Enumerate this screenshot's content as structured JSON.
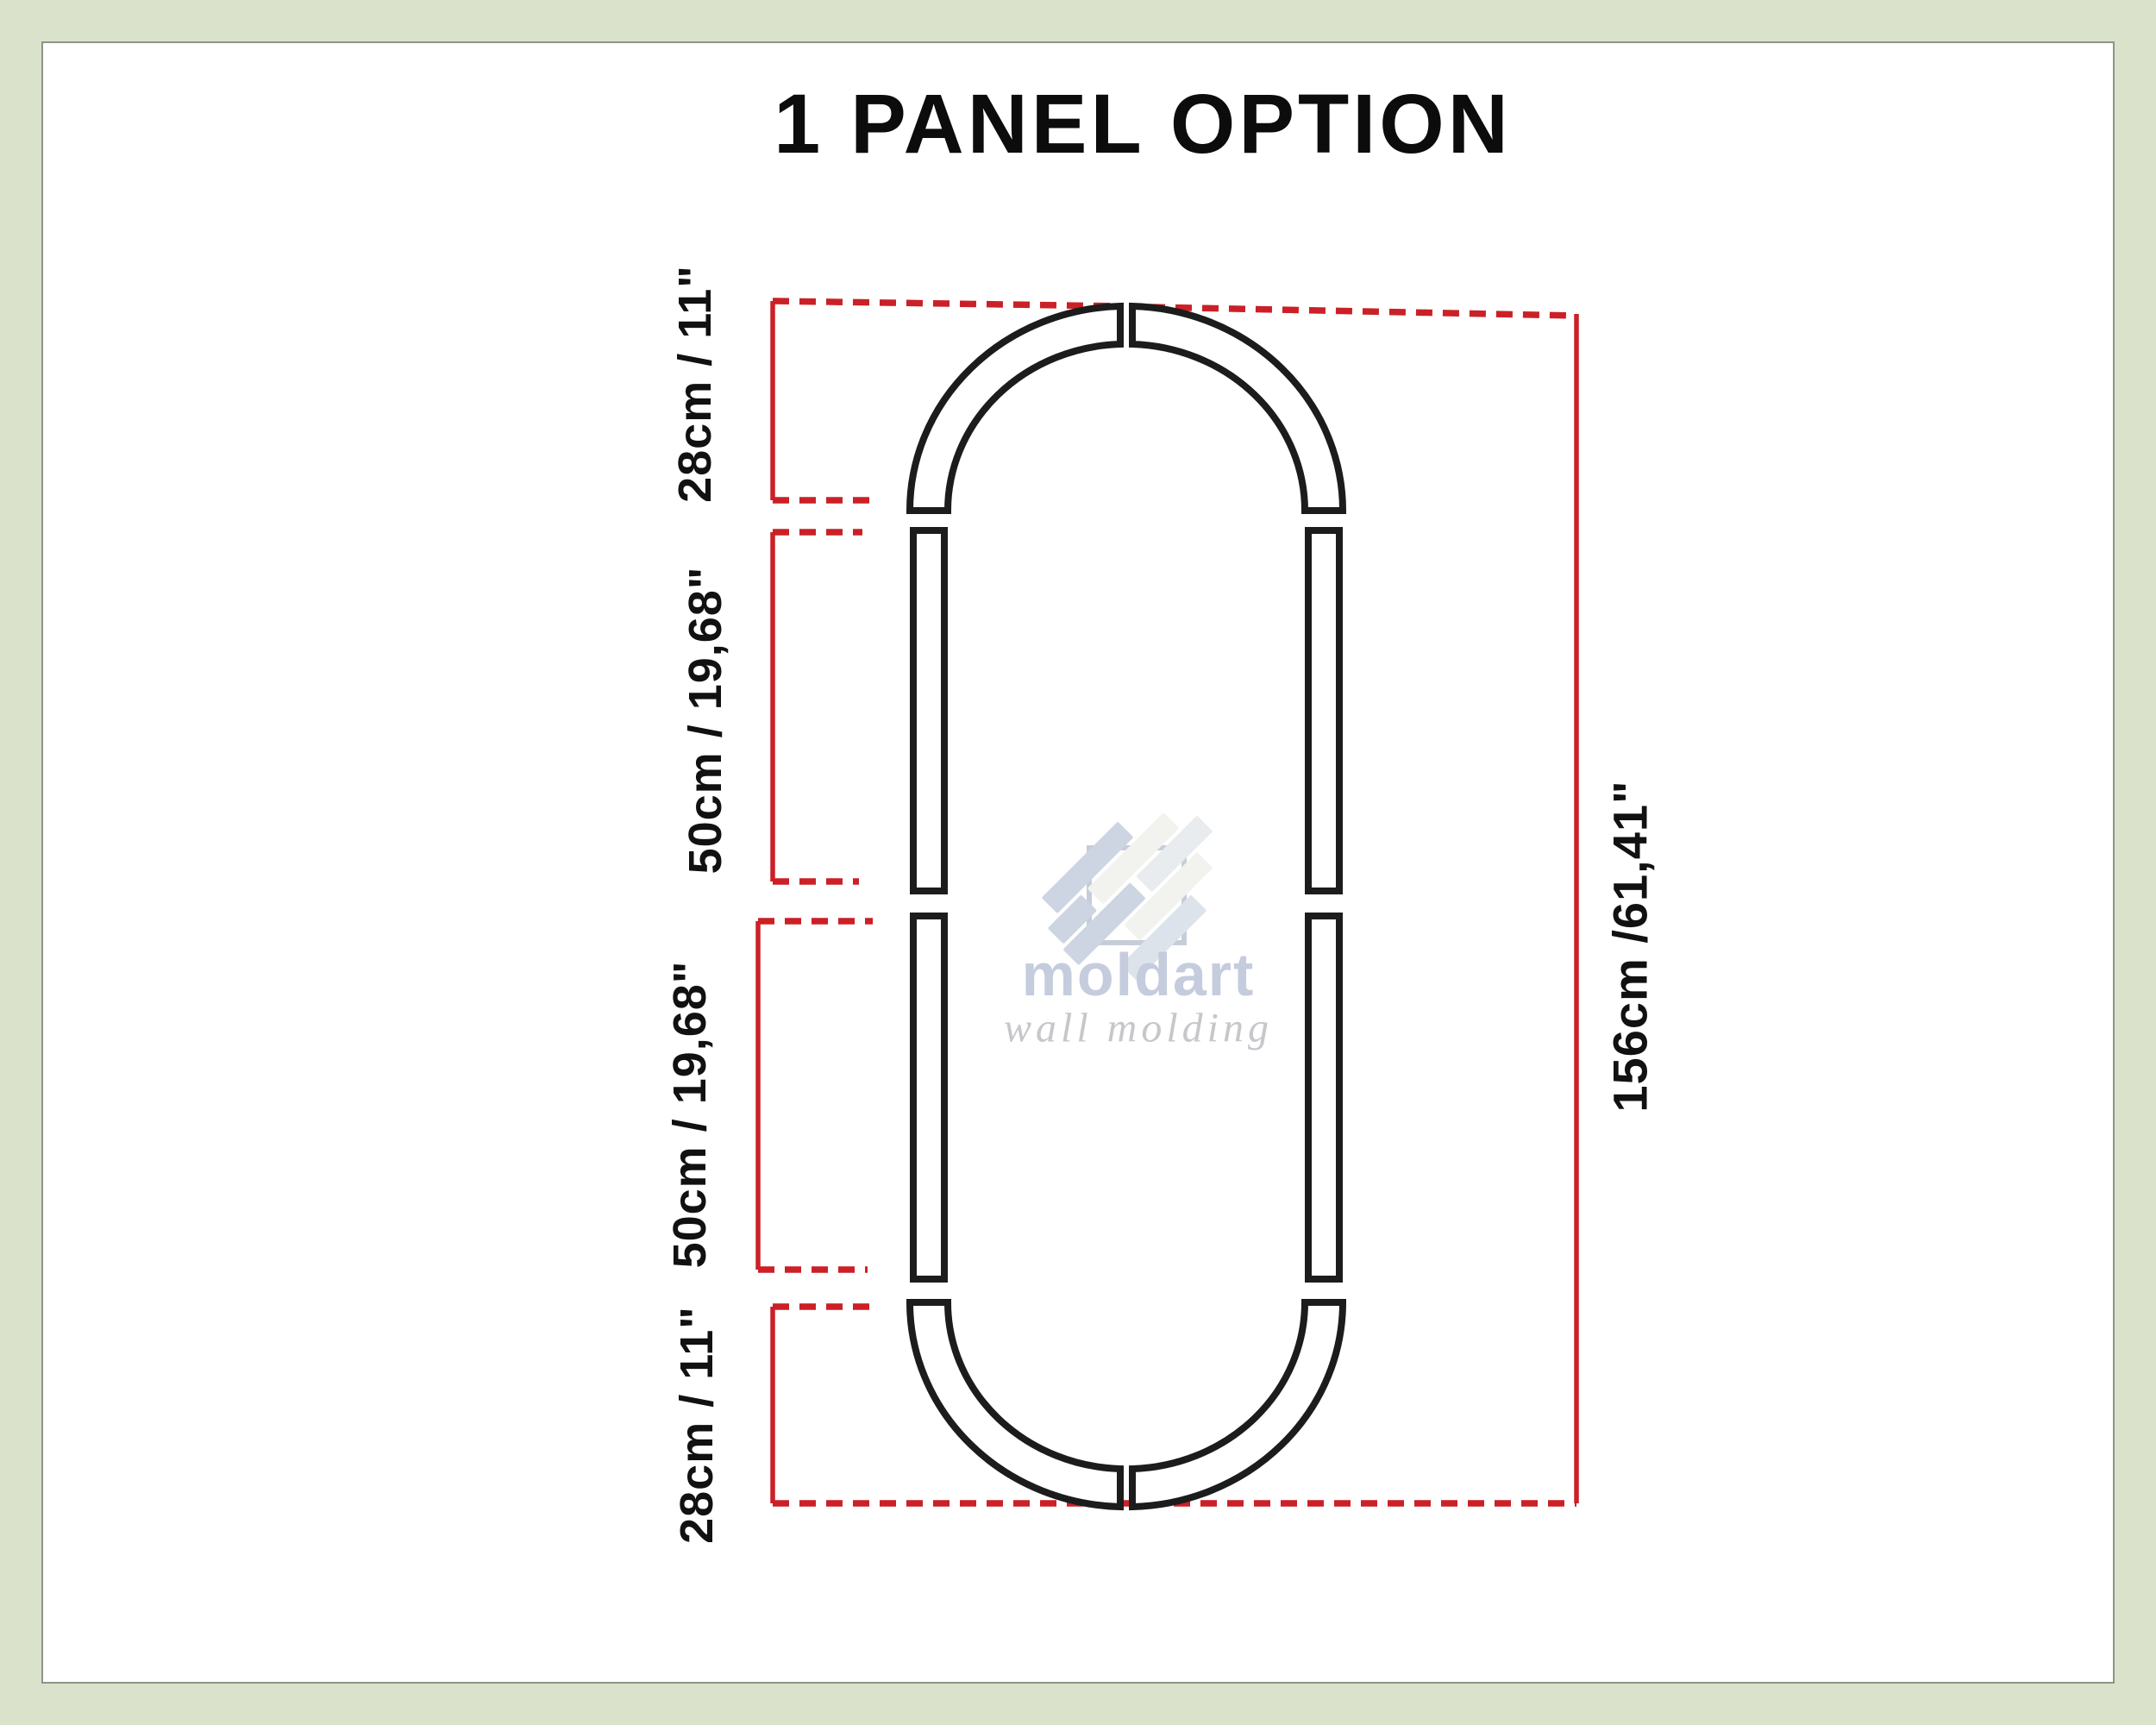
{
  "title": "1 PANEL OPTION",
  "dimensions": {
    "top_arch": "28cm / 11\"",
    "upper_straight": "50cm / 19,68\"",
    "lower_straight": "50cm / 19,68\"",
    "bottom_arch": "28cm / 11\"",
    "total_height": "156cm /61,41\""
  },
  "watermark": {
    "brand": "moldart",
    "tagline": "wall molding"
  },
  "colors": {
    "dimension_red": "#cb2027",
    "molding_stroke": "#1c1c1c",
    "background": "#dbe2cb",
    "panel": "#ffffff",
    "watermark_blue": "#c4ccdd",
    "watermark_gray": "#c7c7cb"
  }
}
